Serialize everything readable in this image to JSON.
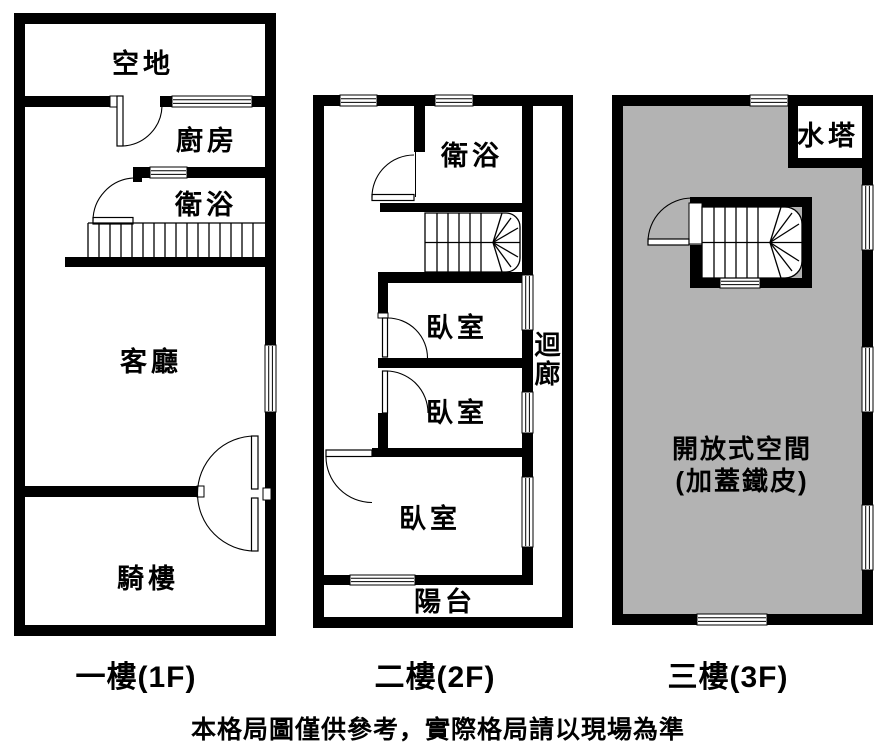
{
  "colors": {
    "wall": "#000000",
    "background": "#ffffff",
    "covered_area_fill": "#b3b3b3"
  },
  "floors": [
    {
      "label": "一樓(1F)",
      "rooms": {
        "vacant_lot": "空地",
        "kitchen": "廚房",
        "bathroom": "衛浴",
        "living_room": "客廳",
        "arcade": "騎樓"
      }
    },
    {
      "label": "二樓(2F)",
      "rooms": {
        "bathroom": "衛浴",
        "bedroom_1": "臥室",
        "bedroom_2": "臥室",
        "bedroom_3": "臥室",
        "corridor": "迴廊",
        "balcony": "陽台"
      }
    },
    {
      "label": "三樓(3F)",
      "rooms": {
        "water_tank": "水塔",
        "open_space_line1": "開放式空間",
        "open_space_line2": "(加蓋鐵皮)"
      }
    }
  ],
  "footer": {
    "disclaimer": "本格局圖僅供參考，實際格局請以現場為準"
  }
}
